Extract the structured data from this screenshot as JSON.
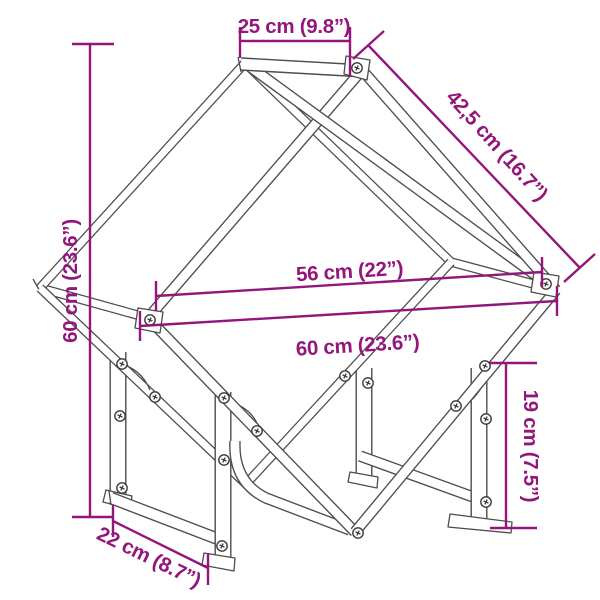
{
  "diagram": {
    "title": "Firewood rack dimension drawing",
    "style": {
      "accent_color": "#93167B",
      "line_color": "#4D4D4D",
      "background": "#FFFFFF"
    },
    "dimensions": {
      "top_depth": "25 cm (9.8”)",
      "diagonal_side": "42,5 cm (16.7”)",
      "inner_width": "56 cm (22”)",
      "outer_width": "60 cm (23.6”)",
      "total_height": "60 cm (23.6”)",
      "leg_height": "19 cm (7.5”)",
      "base_depth": "22 cm (8.7”)"
    }
  }
}
